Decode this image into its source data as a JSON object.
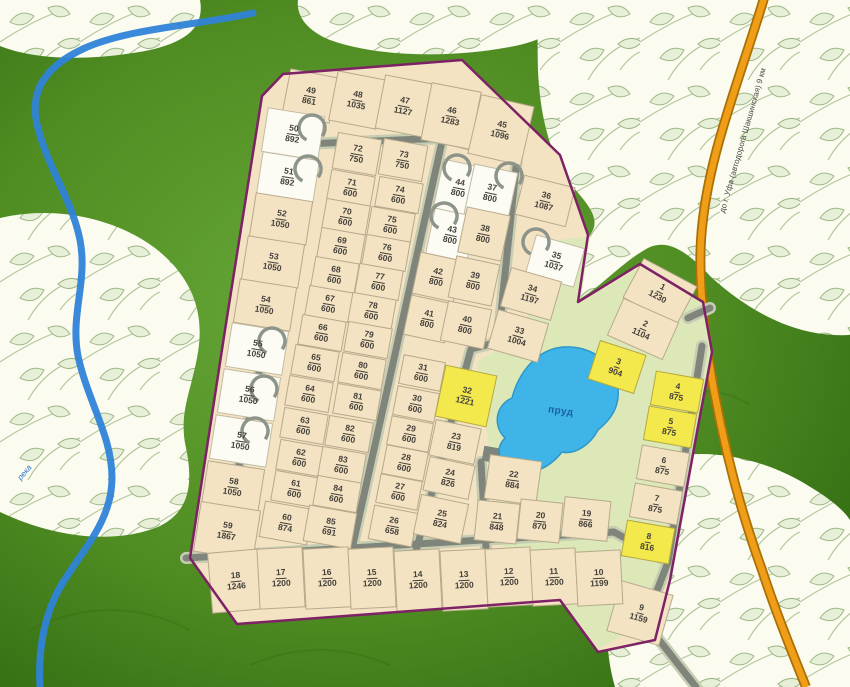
{
  "map": {
    "labels": {
      "pond": "пруд",
      "river": "река",
      "road": "до г. Уфа (автодорога Шакшинская) 9 км"
    },
    "colors": {
      "plot_beige": "#f3e3c3",
      "plot_reserved_white": "#fcfbf4",
      "plot_featured_yellow": "#f4e94c",
      "boundary_purple": "#7e2266",
      "pond_blue": "#3fb4e8",
      "highway_orange": "#f09d18",
      "river_blue": "#2f83d8",
      "background_green": "#4c8a1f",
      "common_area_green": "#dce8b8"
    },
    "plots": [
      {
        "n": "49",
        "a": "861",
        "x": 310,
        "y": 96,
        "w": 48,
        "h": 46,
        "r": 11
      },
      {
        "n": "48",
        "a": "1035",
        "x": 357,
        "y": 100,
        "w": 48,
        "h": 50,
        "r": 11
      },
      {
        "n": "47",
        "a": "1127",
        "x": 404,
        "y": 106,
        "w": 48,
        "h": 54,
        "r": 11
      },
      {
        "n": "46",
        "a": "1283",
        "x": 451,
        "y": 116,
        "w": 50,
        "h": 58,
        "r": 11
      },
      {
        "n": "45",
        "a": "1096",
        "x": 501,
        "y": 130,
        "w": 54,
        "h": 60,
        "r": 13
      },
      {
        "n": "50",
        "a": "892",
        "x": 293,
        "y": 134,
        "w": 57,
        "h": 44,
        "r": 9,
        "c": "w"
      },
      {
        "n": "51",
        "a": "892",
        "x": 288,
        "y": 177,
        "w": 57,
        "h": 42,
        "r": 9,
        "c": "w"
      },
      {
        "n": "52",
        "a": "1050",
        "x": 281,
        "y": 219,
        "w": 57,
        "h": 44,
        "r": 9
      },
      {
        "n": "53",
        "a": "1050",
        "x": 273,
        "y": 262,
        "w": 57,
        "h": 44,
        "r": 9
      },
      {
        "n": "54",
        "a": "1050",
        "x": 265,
        "y": 305,
        "w": 57,
        "h": 44,
        "r": 9
      },
      {
        "n": "55",
        "a": "1050",
        "x": 257,
        "y": 349,
        "w": 57,
        "h": 44,
        "r": 9,
        "c": "w"
      },
      {
        "n": "56",
        "a": "1050",
        "x": 249,
        "y": 395,
        "w": 57,
        "h": 44,
        "r": 9,
        "c": "w"
      },
      {
        "n": "57",
        "a": "1050",
        "x": 241,
        "y": 441,
        "w": 57,
        "h": 44,
        "r": 9,
        "c": "w"
      },
      {
        "n": "58",
        "a": "1050",
        "x": 233,
        "y": 487,
        "w": 57,
        "h": 44,
        "r": 9
      },
      {
        "n": "59",
        "a": "1867",
        "x": 227,
        "y": 531,
        "w": 60,
        "h": 50,
        "r": 9
      },
      {
        "n": "72",
        "a": "750",
        "x": 357,
        "y": 154,
        "w": 44,
        "h": 36,
        "r": 10
      },
      {
        "n": "71",
        "a": "600",
        "x": 351,
        "y": 188,
        "w": 44,
        "h": 30,
        "r": 10
      },
      {
        "n": "70",
        "a": "600",
        "x": 346,
        "y": 217,
        "w": 44,
        "h": 30,
        "r": 10
      },
      {
        "n": "69",
        "a": "600",
        "x": 341,
        "y": 246,
        "w": 44,
        "h": 30,
        "r": 10
      },
      {
        "n": "68",
        "a": "600",
        "x": 335,
        "y": 275,
        "w": 44,
        "h": 30,
        "r": 10
      },
      {
        "n": "67",
        "a": "600",
        "x": 329,
        "y": 304,
        "w": 44,
        "h": 30,
        "r": 10
      },
      {
        "n": "66",
        "a": "600",
        "x": 322,
        "y": 333,
        "w": 44,
        "h": 30,
        "r": 10
      },
      {
        "n": "65",
        "a": "600",
        "x": 315,
        "y": 363,
        "w": 44,
        "h": 30,
        "r": 10
      },
      {
        "n": "64",
        "a": "600",
        "x": 309,
        "y": 394,
        "w": 44,
        "h": 30,
        "r": 10
      },
      {
        "n": "63",
        "a": "600",
        "x": 304,
        "y": 426,
        "w": 44,
        "h": 30,
        "r": 10
      },
      {
        "n": "62",
        "a": "600",
        "x": 300,
        "y": 458,
        "w": 44,
        "h": 30,
        "r": 10
      },
      {
        "n": "61",
        "a": "600",
        "x": 295,
        "y": 489,
        "w": 44,
        "h": 30,
        "r": 10
      },
      {
        "n": "60",
        "a": "874",
        "x": 286,
        "y": 523,
        "w": 48,
        "h": 36,
        "r": 10
      },
      {
        "n": "73",
        "a": "750",
        "x": 403,
        "y": 160,
        "w": 44,
        "h": 36,
        "r": 10
      },
      {
        "n": "74",
        "a": "600",
        "x": 399,
        "y": 195,
        "w": 44,
        "h": 30,
        "r": 10
      },
      {
        "n": "75",
        "a": "600",
        "x": 391,
        "y": 225,
        "w": 44,
        "h": 30,
        "r": 10
      },
      {
        "n": "76",
        "a": "600",
        "x": 386,
        "y": 253,
        "w": 44,
        "h": 30,
        "r": 10
      },
      {
        "n": "77",
        "a": "600",
        "x": 379,
        "y": 282,
        "w": 44,
        "h": 30,
        "r": 10
      },
      {
        "n": "78",
        "a": "600",
        "x": 372,
        "y": 311,
        "w": 44,
        "h": 30,
        "r": 10
      },
      {
        "n": "79",
        "a": "600",
        "x": 368,
        "y": 340,
        "w": 44,
        "h": 30,
        "r": 10
      },
      {
        "n": "80",
        "a": "600",
        "x": 362,
        "y": 371,
        "w": 44,
        "h": 30,
        "r": 10
      },
      {
        "n": "81",
        "a": "600",
        "x": 357,
        "y": 402,
        "w": 44,
        "h": 30,
        "r": 10
      },
      {
        "n": "82",
        "a": "600",
        "x": 349,
        "y": 434,
        "w": 44,
        "h": 30,
        "r": 10
      },
      {
        "n": "83",
        "a": "600",
        "x": 342,
        "y": 465,
        "w": 44,
        "h": 30,
        "r": 10
      },
      {
        "n": "84",
        "a": "600",
        "x": 337,
        "y": 494,
        "w": 44,
        "h": 30,
        "r": 10
      },
      {
        "n": "85",
        "a": "691",
        "x": 330,
        "y": 527,
        "w": 48,
        "h": 36,
        "r": 10
      },
      {
        "n": "44",
        "a": "800",
        "x": 459,
        "y": 188,
        "w": 42,
        "h": 50,
        "r": 12,
        "c": "w"
      },
      {
        "n": "43",
        "a": "800",
        "x": 451,
        "y": 235,
        "w": 42,
        "h": 46,
        "r": 12,
        "c": "w"
      },
      {
        "n": "42",
        "a": "800",
        "x": 437,
        "y": 277,
        "w": 42,
        "h": 42,
        "r": 12
      },
      {
        "n": "41",
        "a": "800",
        "x": 428,
        "y": 319,
        "w": 42,
        "h": 40,
        "r": 12
      },
      {
        "n": "37",
        "a": "800",
        "x": 491,
        "y": 193,
        "w": 44,
        "h": 50,
        "r": 12,
        "c": "w"
      },
      {
        "n": "38",
        "a": "800",
        "x": 484,
        "y": 234,
        "w": 44,
        "h": 46,
        "r": 12
      },
      {
        "n": "39",
        "a": "800",
        "x": 474,
        "y": 281,
        "w": 44,
        "h": 42,
        "r": 12
      },
      {
        "n": "40",
        "a": "800",
        "x": 466,
        "y": 325,
        "w": 44,
        "h": 40,
        "r": 12
      },
      {
        "n": "31",
        "a": "600",
        "x": 422,
        "y": 373,
        "w": 42,
        "h": 29,
        "r": 11
      },
      {
        "n": "30",
        "a": "600",
        "x": 416,
        "y": 404,
        "w": 42,
        "h": 29,
        "r": 11
      },
      {
        "n": "29",
        "a": "600",
        "x": 410,
        "y": 434,
        "w": 42,
        "h": 29,
        "r": 11
      },
      {
        "n": "28",
        "a": "600",
        "x": 405,
        "y": 463,
        "w": 42,
        "h": 29,
        "r": 11
      },
      {
        "n": "27",
        "a": "600",
        "x": 399,
        "y": 492,
        "w": 42,
        "h": 29,
        "r": 11
      },
      {
        "n": "26",
        "a": "658",
        "x": 393,
        "y": 526,
        "w": 44,
        "h": 34,
        "r": 11
      },
      {
        "n": "32",
        "a": "1221",
        "x": 466,
        "y": 396,
        "w": 52,
        "h": 52,
        "r": 12,
        "c": "y"
      },
      {
        "n": "23",
        "a": "819",
        "x": 455,
        "y": 442,
        "w": 46,
        "h": 36,
        "r": 12
      },
      {
        "n": "24",
        "a": "826",
        "x": 449,
        "y": 478,
        "w": 46,
        "h": 34,
        "r": 12
      },
      {
        "n": "25",
        "a": "824",
        "x": 441,
        "y": 519,
        "w": 48,
        "h": 40,
        "r": 12
      },
      {
        "n": "22",
        "a": "884",
        "x": 513,
        "y": 480,
        "w": 52,
        "h": 44,
        "r": 8
      },
      {
        "n": "21",
        "a": "848",
        "x": 497,
        "y": 522,
        "w": 42,
        "h": 40,
        "r": 6
      },
      {
        "n": "20",
        "a": "870",
        "x": 540,
        "y": 521,
        "w": 42,
        "h": 40,
        "r": 6
      },
      {
        "n": "19",
        "a": "866",
        "x": 586,
        "y": 519,
        "w": 46,
        "h": 40,
        "r": 6
      },
      {
        "n": "36",
        "a": "1087",
        "x": 545,
        "y": 201,
        "w": 52,
        "h": 40,
        "r": 14
      },
      {
        "n": "35",
        "a": "1037",
        "x": 555,
        "y": 261,
        "w": 50,
        "h": 40,
        "r": 16,
        "c": "w"
      },
      {
        "n": "34",
        "a": "1197",
        "x": 531,
        "y": 294,
        "w": 52,
        "h": 40,
        "r": 16
      },
      {
        "n": "33",
        "a": "1004",
        "x": 518,
        "y": 336,
        "w": 52,
        "h": 40,
        "r": 16
      },
      {
        "n": "1",
        "a": "1230",
        "x": 660,
        "y": 292,
        "w": 60,
        "h": 44,
        "r": 28
      },
      {
        "n": "2",
        "a": "1104",
        "x": 643,
        "y": 329,
        "w": 60,
        "h": 40,
        "r": 24
      },
      {
        "n": "3",
        "a": "904",
        "x": 617,
        "y": 367,
        "w": 48,
        "h": 40,
        "r": 18,
        "c": "y"
      },
      {
        "n": "4",
        "a": "875",
        "x": 677,
        "y": 392,
        "w": 48,
        "h": 34,
        "r": 10,
        "c": "y"
      },
      {
        "n": "5",
        "a": "875",
        "x": 670,
        "y": 427,
        "w": 48,
        "h": 34,
        "r": 10,
        "c": "y"
      },
      {
        "n": "6",
        "a": "875",
        "x": 663,
        "y": 466,
        "w": 48,
        "h": 34,
        "r": 10
      },
      {
        "n": "7",
        "a": "875",
        "x": 656,
        "y": 504,
        "w": 48,
        "h": 34,
        "r": 10
      },
      {
        "n": "8",
        "a": "816",
        "x": 648,
        "y": 542,
        "w": 48,
        "h": 36,
        "r": 10,
        "c": "y"
      },
      {
        "n": "9",
        "a": "1159",
        "x": 640,
        "y": 613,
        "w": 54,
        "h": 52,
        "r": 16
      },
      {
        "n": "18",
        "a": "1246",
        "x": 236,
        "y": 581,
        "w": 52,
        "h": 60,
        "r": -5
      },
      {
        "n": "17",
        "a": "1200",
        "x": 281,
        "y": 578,
        "w": 45,
        "h": 60,
        "r": -3
      },
      {
        "n": "16",
        "a": "1200",
        "x": 327,
        "y": 578,
        "w": 45,
        "h": 60,
        "r": -3
      },
      {
        "n": "15",
        "a": "1200",
        "x": 372,
        "y": 578,
        "w": 45,
        "h": 60,
        "r": -3
      },
      {
        "n": "14",
        "a": "1200",
        "x": 418,
        "y": 580,
        "w": 45,
        "h": 60,
        "r": -3
      },
      {
        "n": "13",
        "a": "1200",
        "x": 464,
        "y": 580,
        "w": 45,
        "h": 60,
        "r": -3
      },
      {
        "n": "12",
        "a": "1200",
        "x": 509,
        "y": 577,
        "w": 45,
        "h": 58,
        "r": -3
      },
      {
        "n": "11",
        "a": "1200",
        "x": 554,
        "y": 577,
        "w": 45,
        "h": 56,
        "r": -3
      },
      {
        "n": "10",
        "a": "1199",
        "x": 599,
        "y": 578,
        "w": 45,
        "h": 54,
        "r": -3
      }
    ],
    "rings": [
      {
        "x": 312,
        "y": 128
      },
      {
        "x": 308,
        "y": 169
      },
      {
        "x": 272,
        "y": 341
      },
      {
        "x": 264,
        "y": 389
      },
      {
        "x": 255,
        "y": 431
      },
      {
        "x": 457,
        "y": 168
      },
      {
        "x": 509,
        "y": 176
      },
      {
        "x": 444,
        "y": 216
      },
      {
        "x": 536,
        "y": 242
      }
    ]
  }
}
